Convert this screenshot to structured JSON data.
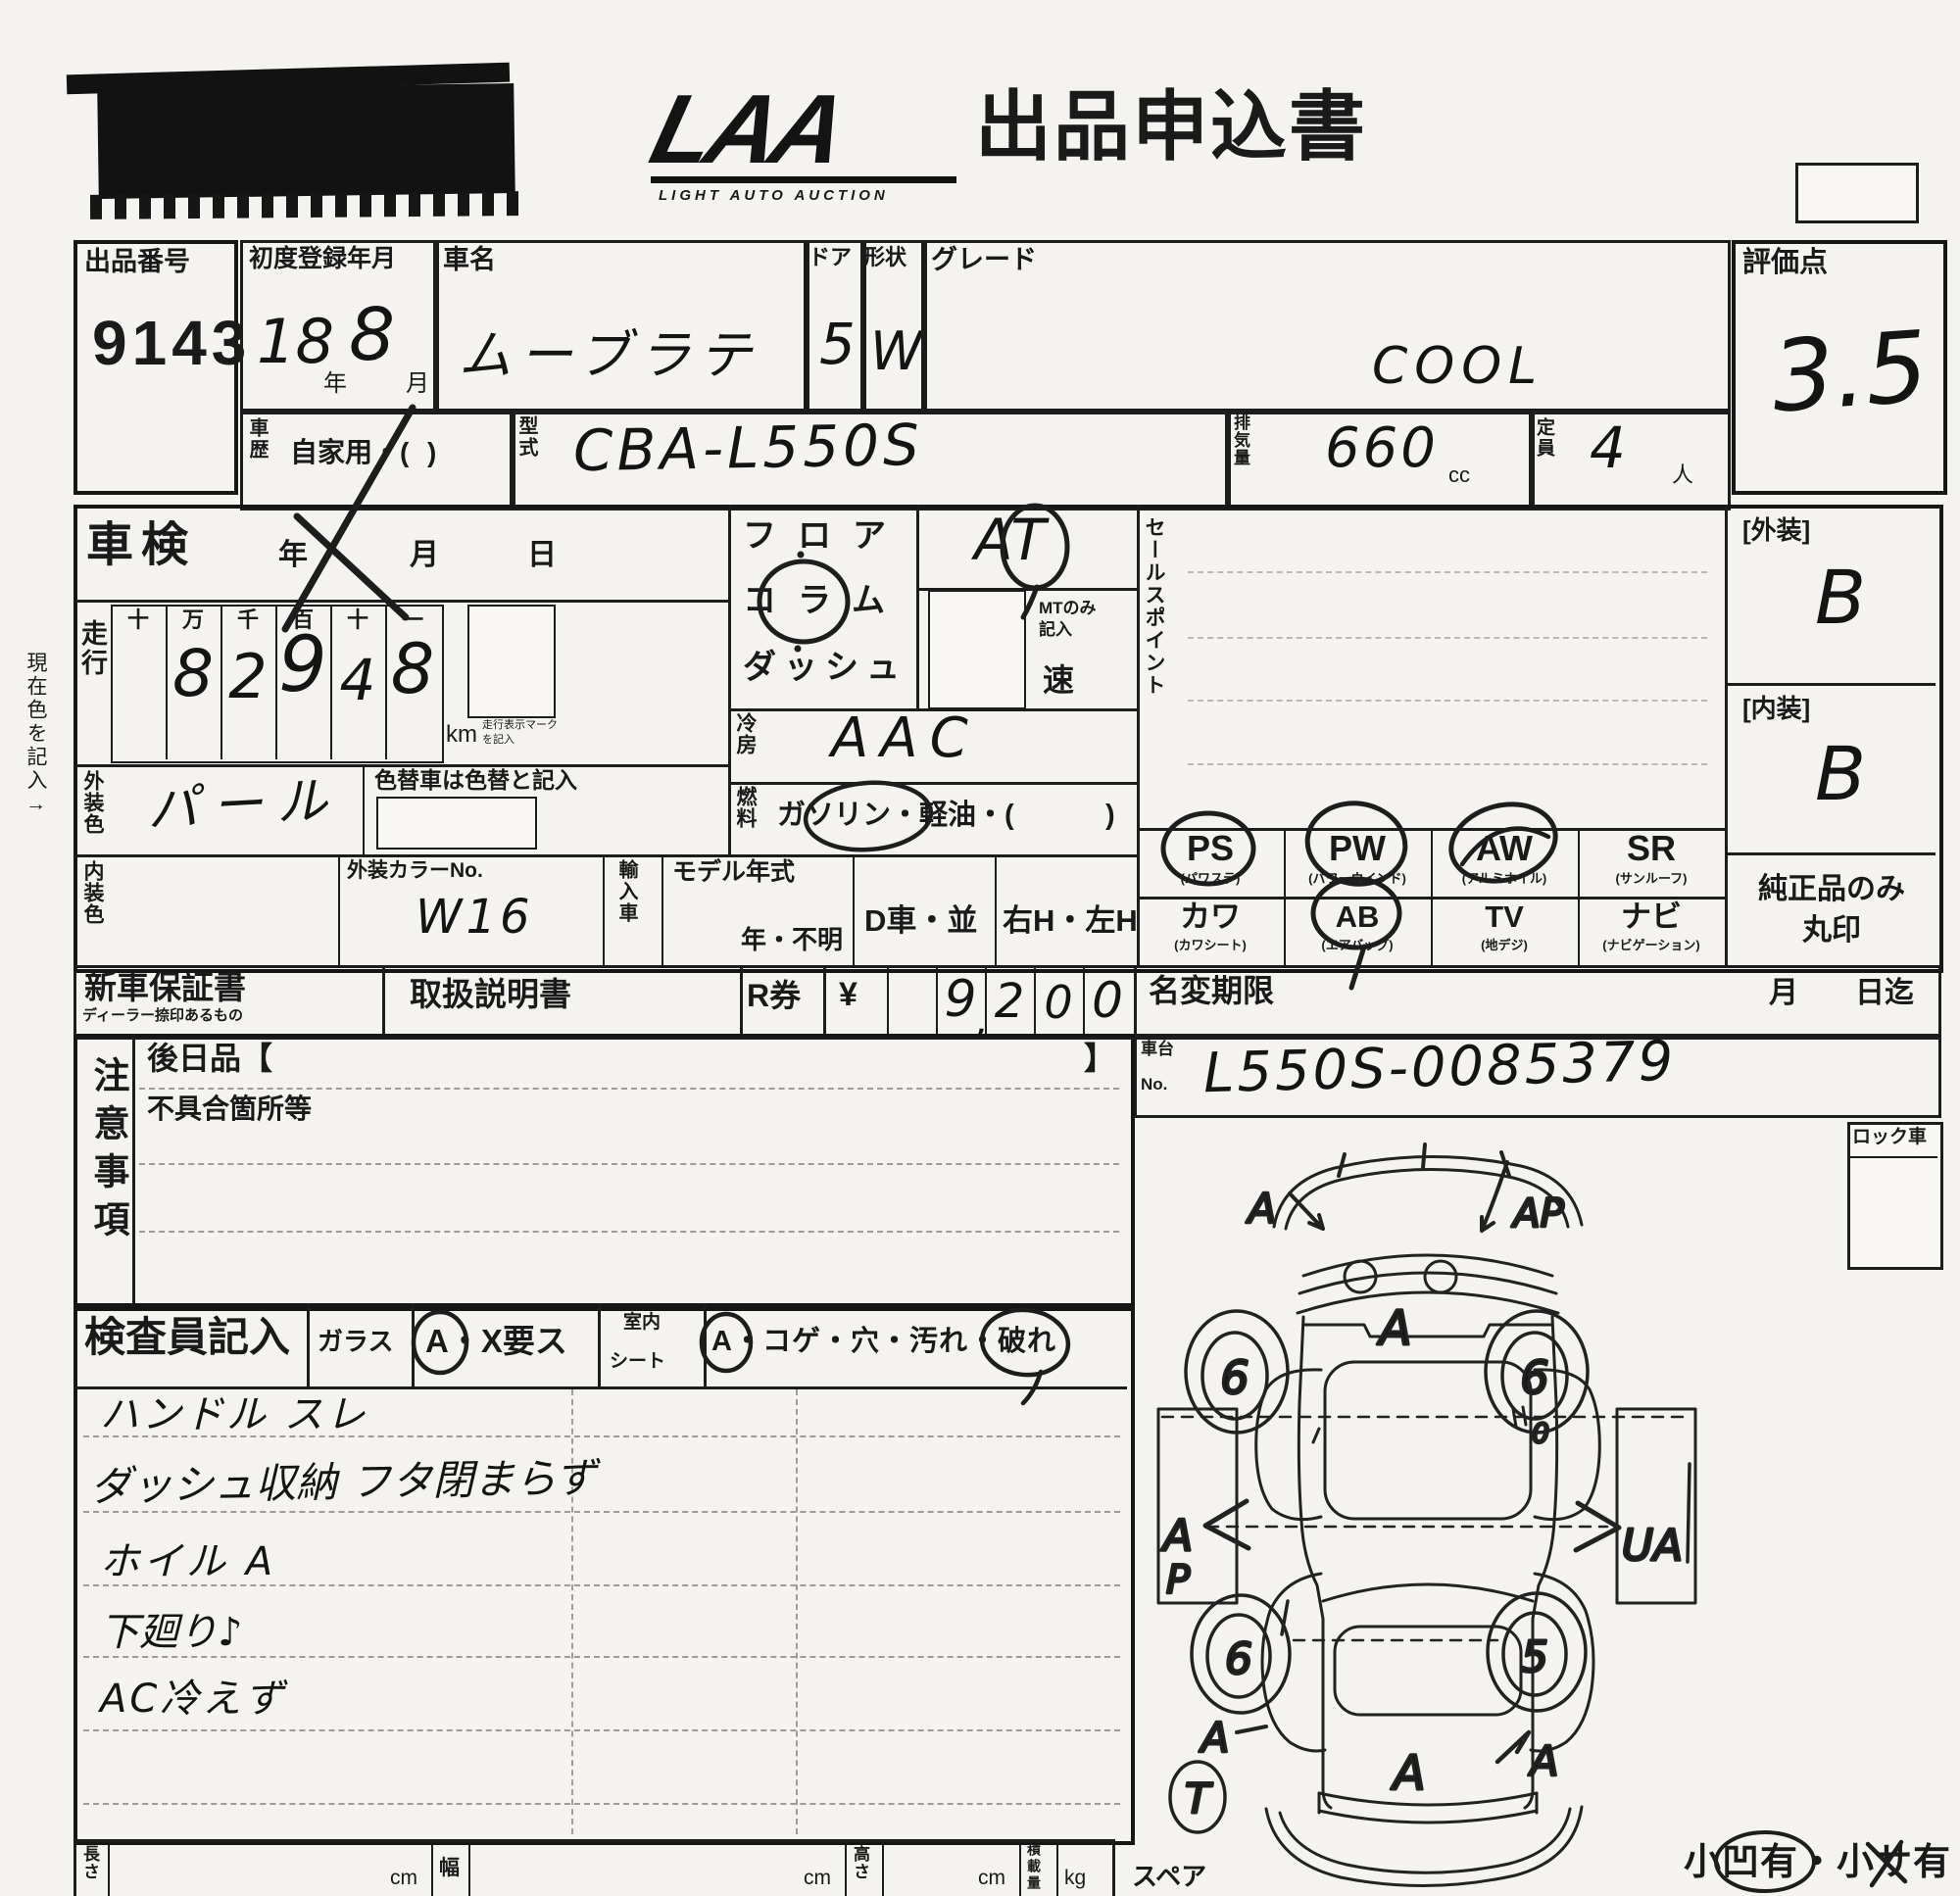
{
  "header": {
    "logo": "LAA",
    "logo_sub": "LIGHT AUTO AUCTION",
    "title": "出品申込書"
  },
  "top": {
    "entry_no": {
      "label": "出品番号",
      "value": "9143"
    },
    "first_reg": {
      "label": "初度登録年月",
      "year": "18",
      "year_suffix": "年",
      "month": "8",
      "month_suffix": "月"
    },
    "car_name": {
      "label": "車名",
      "value": "ムーブラテ"
    },
    "doors": {
      "label": "ドア",
      "value": "5"
    },
    "body_shape": {
      "label": "形状",
      "value": "W"
    },
    "grade": {
      "label": "グレード",
      "value": "COOL"
    },
    "score": {
      "label": "評価点",
      "value": "3.5"
    },
    "history": {
      "label": "車歴",
      "value": "自家用・(",
      "paren_close": ")"
    },
    "model_code": {
      "label": "型式",
      "value": "CBA-L550S"
    },
    "displacement": {
      "label": "排気量",
      "value": "660",
      "unit": "cc"
    },
    "capacity": {
      "label": "定員",
      "value": "4",
      "unit": "人"
    }
  },
  "left_margin_note": "現在色を記入→",
  "inspection": {
    "label": "車検",
    "year": "年",
    "month": "月",
    "day": "日"
  },
  "mileage": {
    "label": "走行",
    "headers": [
      "十",
      "万",
      "千",
      "百",
      "十",
      "一"
    ],
    "digits": [
      "",
      "8",
      "2",
      "9",
      "4",
      "8"
    ],
    "unit": "km",
    "unit_note_1": "走行表示マーク",
    "unit_note_2": "を記入"
  },
  "ext_color": {
    "label": "外装色",
    "value": "パール"
  },
  "color_change": {
    "label": "色替車は色替と記入"
  },
  "int_color": {
    "label": "内装色"
  },
  "color_no": {
    "label": "外装カラーNo.",
    "value": "W16"
  },
  "import_car": {
    "label": "輸入車"
  },
  "model_year": {
    "label": "モデル年式",
    "value": "年・不明"
  },
  "d_car": {
    "label": "D車・並"
  },
  "handle_pos": {
    "label": "右H・左H"
  },
  "shift": {
    "floor": "フロア",
    "column": "コラム",
    "dash": "ダッシュ",
    "trans": "AT",
    "mt_note_1": "MTのみ",
    "mt_note_2": "記入",
    "speed_suffix": "速"
  },
  "aircon": {
    "label": "冷房",
    "value": "AAC"
  },
  "fuel": {
    "label": "燃料",
    "value": "ガソリン・軽油・(",
    "paren_close": ")"
  },
  "sales_point": {
    "label": "セールスポイント"
  },
  "equipment": {
    "row1": [
      {
        "code": "PS",
        "sub": "(パワステ)"
      },
      {
        "code": "PW",
        "sub": "(パワーウインド)"
      },
      {
        "code": "AW",
        "sub": "(アルミホイル)"
      },
      {
        "code": "SR",
        "sub": "(サンルーフ)"
      }
    ],
    "row2": [
      {
        "code": "カワ",
        "sub": "(カワシート)"
      },
      {
        "code": "AB",
        "sub": "(エアバッグ)"
      },
      {
        "code": "TV",
        "sub": "(地デジ)"
      },
      {
        "code": "ナビ",
        "sub": "(ナビゲーション)"
      }
    ],
    "genuine_note_1": "純正品のみ",
    "genuine_note_2": "丸印"
  },
  "grades": {
    "exterior_label": "[外装]",
    "exterior": "B",
    "interior_label": "[内装]",
    "interior": "B"
  },
  "docs": {
    "warranty": "新車保証書",
    "warranty_sub": "ディーラー捺印あるもの",
    "manual": "取扱説明書",
    "r_ticket": "R券",
    "yen": "¥",
    "amount_digits": [
      "",
      "9",
      "2",
      "0",
      "0"
    ],
    "comma": ","
  },
  "name_change": {
    "label": "名変期限",
    "month": "月",
    "day_until": "日迄"
  },
  "chassis": {
    "label_1": "車台",
    "label_2": "No.",
    "value": "L550S-0085379"
  },
  "cautions": {
    "label": "注意事項",
    "later_goods": "後日品【",
    "bracket_close": "】",
    "defects": "不具合箇所等"
  },
  "inspector": {
    "label": "検査員記入",
    "glass_label": "ガラス",
    "glass_options": "A・X要ス",
    "seat_label_1": "室内",
    "seat_label_2": "シート",
    "seat_options": "A・コゲ・穴・汚れ・破れ",
    "notes": [
      "ハンドル スレ",
      "ダッシュ収納 フタ閉まらず",
      "ホイル A",
      "下廻り♪",
      "AC冷えず"
    ]
  },
  "dimensions": {
    "length": "長さ",
    "width": "幅",
    "height": "高さ",
    "load": "積載量",
    "cm": "cm",
    "kg": "kg"
  },
  "lock_car": {
    "label": "ロック車"
  },
  "spare": {
    "label": "スペア",
    "mark": "T"
  },
  "footer_note": "小凹有・小サ有",
  "diagram": {
    "front_left": "A",
    "front_right": "AP",
    "hood": "A",
    "wheel_fl": "6",
    "wheel_fr": "6",
    "wheel_rl": "6",
    "wheel_rr": "5",
    "mid_left": "A",
    "mid_left2": "P",
    "mid_right": "UA",
    "rear_left": "A",
    "rear_right": "A",
    "hatch": "A",
    "door_mark": "0"
  }
}
